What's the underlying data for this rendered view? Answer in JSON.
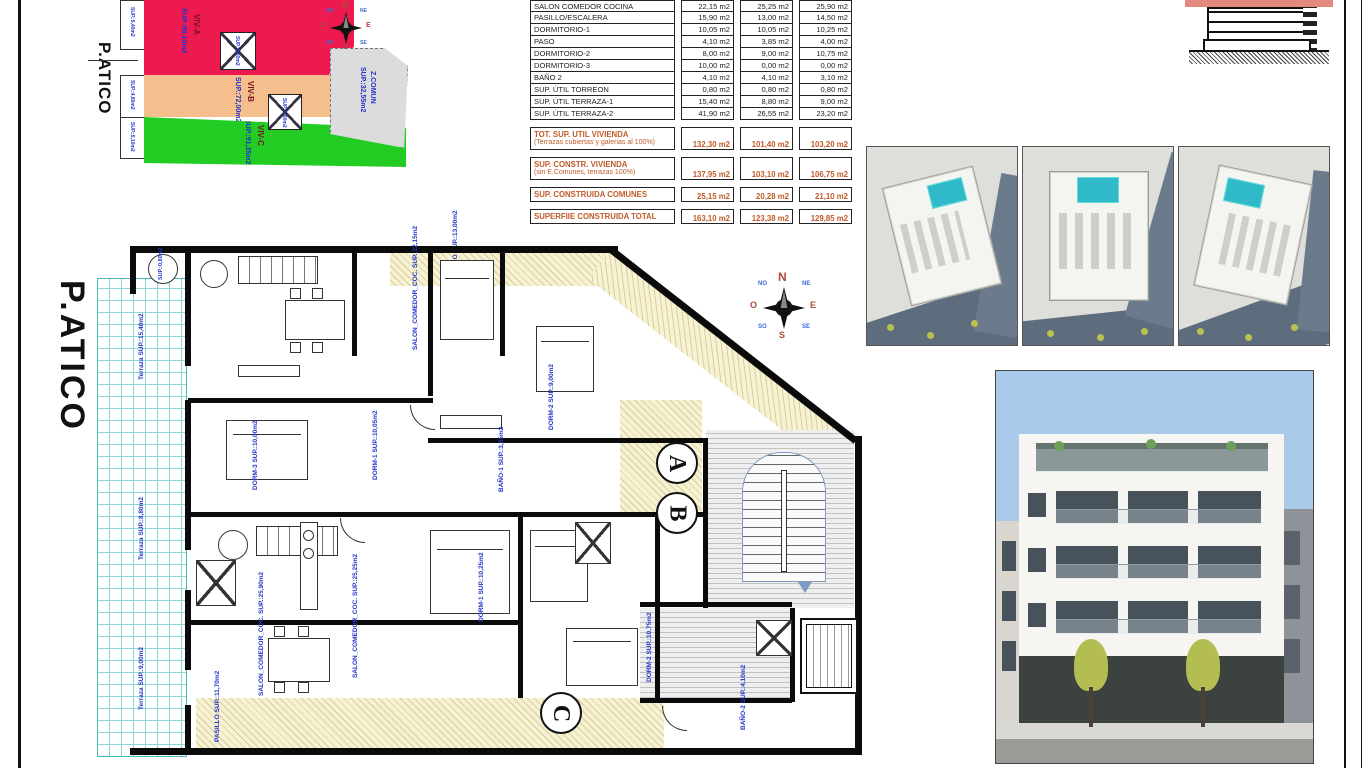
{
  "sheet": {
    "type": "architectural plan sheet"
  },
  "site_plan": {
    "title": "P.ATICO",
    "zones": [
      {
        "name": "VIV-A",
        "sup": "SUP.:98,10m2",
        "color": "#ec1a4e"
      },
      {
        "name": "VIV-B",
        "sup": "SUP.:72,00m2",
        "color": "#f4bf8d"
      },
      {
        "name": "VIV-C",
        "sup": "SUP.:91,35m2",
        "color": "#22cc22"
      },
      {
        "name": "Z.COMUN",
        "sup": "SUP.:32,55m2",
        "color": "#dcdcdc"
      }
    ],
    "edge_labels": [
      "SUP.:5,40m2",
      "SUP.:4,80m2",
      "SUP.:5,10m2"
    ],
    "torreon_labels": [
      "SUP.:0,80m2",
      "SUP.:0,80m2"
    ]
  },
  "compass": {
    "n": "N",
    "e": "E",
    "s": "S",
    "o": "O",
    "ne": "NE",
    "no": "NO",
    "se": "SE",
    "so": "SO"
  },
  "area_table": {
    "rows": [
      {
        "name": "SALON COMEDOR COCINA",
        "values": [
          "22,15 m2",
          "25,25 m2",
          "25,90 m2"
        ]
      },
      {
        "name": "PASILLO/ESCALERA",
        "values": [
          "15,90 m2",
          "13,00 m2",
          "14,50 m2"
        ]
      },
      {
        "name": "DORMITORIO-1",
        "values": [
          "10,05 m2",
          "10,05 m2",
          "10,25 m2"
        ]
      },
      {
        "name": "PASO",
        "values": [
          "4,10 m2",
          "3,85 m2",
          "4,00 m2"
        ]
      },
      {
        "name": "DORMITORIO-2",
        "values": [
          "8,00 m2",
          "9,00 m2",
          "10,75 m2"
        ]
      },
      {
        "name": "DORMITORIO-3",
        "values": [
          "10,00 m2",
          "0,00 m2",
          "0,00 m2"
        ]
      },
      {
        "name": "BAÑO 2",
        "values": [
          "4,10 m2",
          "4,10 m2",
          "3,10 m2"
        ]
      },
      {
        "name": "SUP. ÚTIL TORREON",
        "values": [
          "0,80 m2",
          "0,80 m2",
          "0,80 m2"
        ]
      },
      {
        "name": "SUP. ÚTIL TERRAZA-1",
        "values": [
          "15,40 m2",
          "8,80 m2",
          "9,00 m2"
        ]
      },
      {
        "name": "SUP. ÚTIL TERRAZA-2",
        "values": [
          "41,90 m2",
          "26,55 m2",
          "23,20 m2"
        ]
      }
    ],
    "summary": [
      {
        "name": "TOT. SUP. UTIL VIVIENDA",
        "note": "(Terrazas cubiertas y galerias al 100%)",
        "values": [
          "132,30 m2",
          "101,40 m2",
          "103,20 m2"
        ]
      },
      {
        "name": "SUP. CONSTR. VIVIENDA",
        "note": "(sin E.Comunes, terrazas 100%)",
        "values": [
          "137,95 m2",
          "103,10 m2",
          "106,75 m2"
        ]
      },
      {
        "name": "SUP. CONSTRUIDA COMUNES",
        "note": "",
        "values": [
          "25,15 m2",
          "20,28 m2",
          "21,10 m2"
        ]
      },
      {
        "name": "SUPERFIIE CONSTRUIDA TOTAL",
        "note": "",
        "values": [
          "163,10 m2",
          "123,38 m2",
          "129,85 m2"
        ]
      }
    ],
    "summary_color": "#bf5a28"
  },
  "plan": {
    "title": "P.ATICO",
    "unit_marks": [
      "A",
      "B",
      "C"
    ],
    "labels": [
      "Terraza SUP.:15,40m2",
      "Terraza SUP.:8,80m2",
      "Terraza SUP.:9,00m2",
      "SALON_COMEDOR_COC. SUP.:22,15m2",
      "DORM-3 SUP.:10,00m2",
      "DORM-1 SUP.:10,05m2",
      "PASILLO SUP.:13,00m2",
      "DORM-2 SUP.:9,00m2",
      "BAÑO-1 SUP.:3,85m2",
      "SALON_COMEDOR_COC. SUP.:25,25m2",
      "SALON_COMEDOR_COC. SUP.:25,90m2",
      "DORM-1 SUP.:10,25m2",
      "DORM-2 SUP.:10,75m2",
      "BAÑO-2 SUP.:4,10m2",
      "PASILLO SUP.:11,70m2",
      "SUP.:0,80m2"
    ],
    "label_color": "#2233cc"
  }
}
